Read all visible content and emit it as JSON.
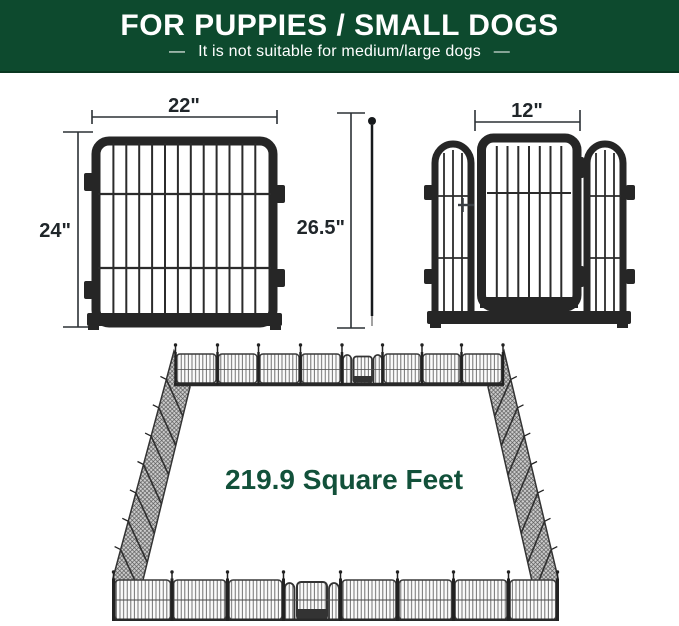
{
  "banner": {
    "title": "FOR PUPPIES / SMALL DOGS",
    "subtitle": "—  It is not suitable for medium/large dogs  —"
  },
  "dimensions": {
    "panel_width": "22\"",
    "panel_height": "24\"",
    "overall_height": "26.5\"",
    "door_width": "12\"",
    "area": "219.9 Square Feet"
  },
  "colors": {
    "banner_green": "#0d4a2e",
    "area_text_green": "#12513a",
    "frame_black": "#262626",
    "dimension_text": "#20262a"
  }
}
